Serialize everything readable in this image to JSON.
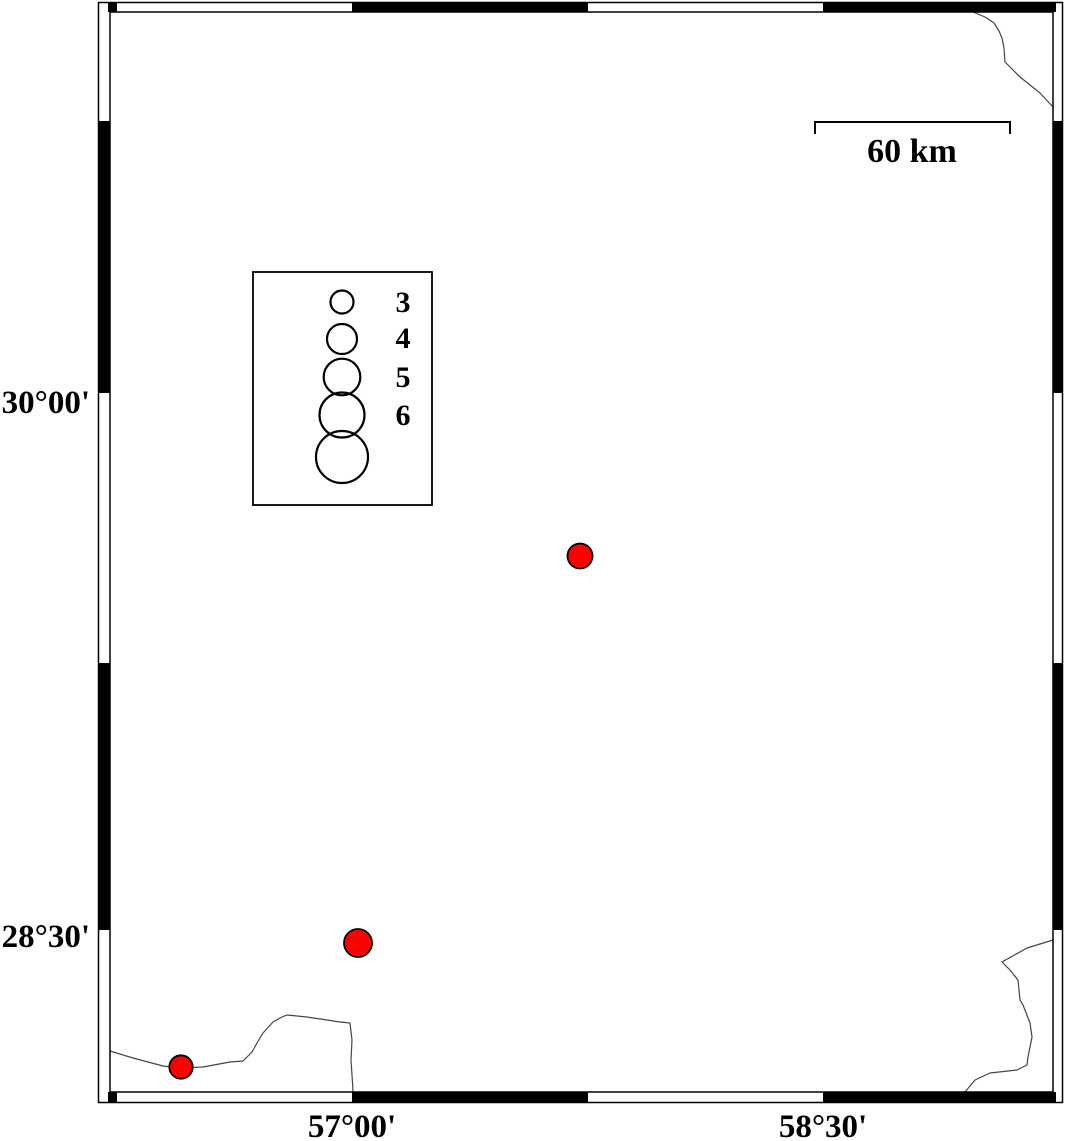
{
  "map": {
    "colors": {
      "background": "#ffffff",
      "frame": "#000000",
      "coastline": "#444444",
      "epicenter_fill": "#ff0000",
      "epicenter_stroke": "#000000"
    },
    "axes": {
      "left": [
        {
          "label": "30°00'",
          "text_x": 90,
          "text_y": 413
        },
        {
          "label": "28°30'",
          "text_x": 90,
          "text_y": 947
        }
      ],
      "bottom": [
        {
          "label": "57°00'",
          "text_x": 352,
          "text_y": 1137
        },
        {
          "label": "58°30'",
          "text_x": 823,
          "text_y": 1137
        }
      ]
    },
    "scale_bar": {
      "label": "60 km",
      "length_km": 60,
      "label_x": 912,
      "label_y": 162
    },
    "legend": {
      "circles_cx": 342,
      "labels_x": 403,
      "items": [
        {
          "magnitude": "3",
          "cy": 302,
          "r": 11.5,
          "label_y": 312
        },
        {
          "magnitude": "4",
          "cy": 339,
          "r": 15,
          "label_y": 348
        },
        {
          "magnitude": "5",
          "cy": 377,
          "r": 18.3,
          "label_y": 387
        },
        {
          "magnitude": "6",
          "cy": 415,
          "r": 22.5,
          "label_y": 425
        },
        {
          "cy": 457,
          "r": 26
        }
      ]
    },
    "epicenters": {
      "points": [
        {
          "cx": 580,
          "cy": 556,
          "r": 12.5
        },
        {
          "cx": 358,
          "cy": 943,
          "r": 14
        },
        {
          "cx": 181,
          "cy": 1067,
          "r": 11.7
        }
      ]
    }
  }
}
